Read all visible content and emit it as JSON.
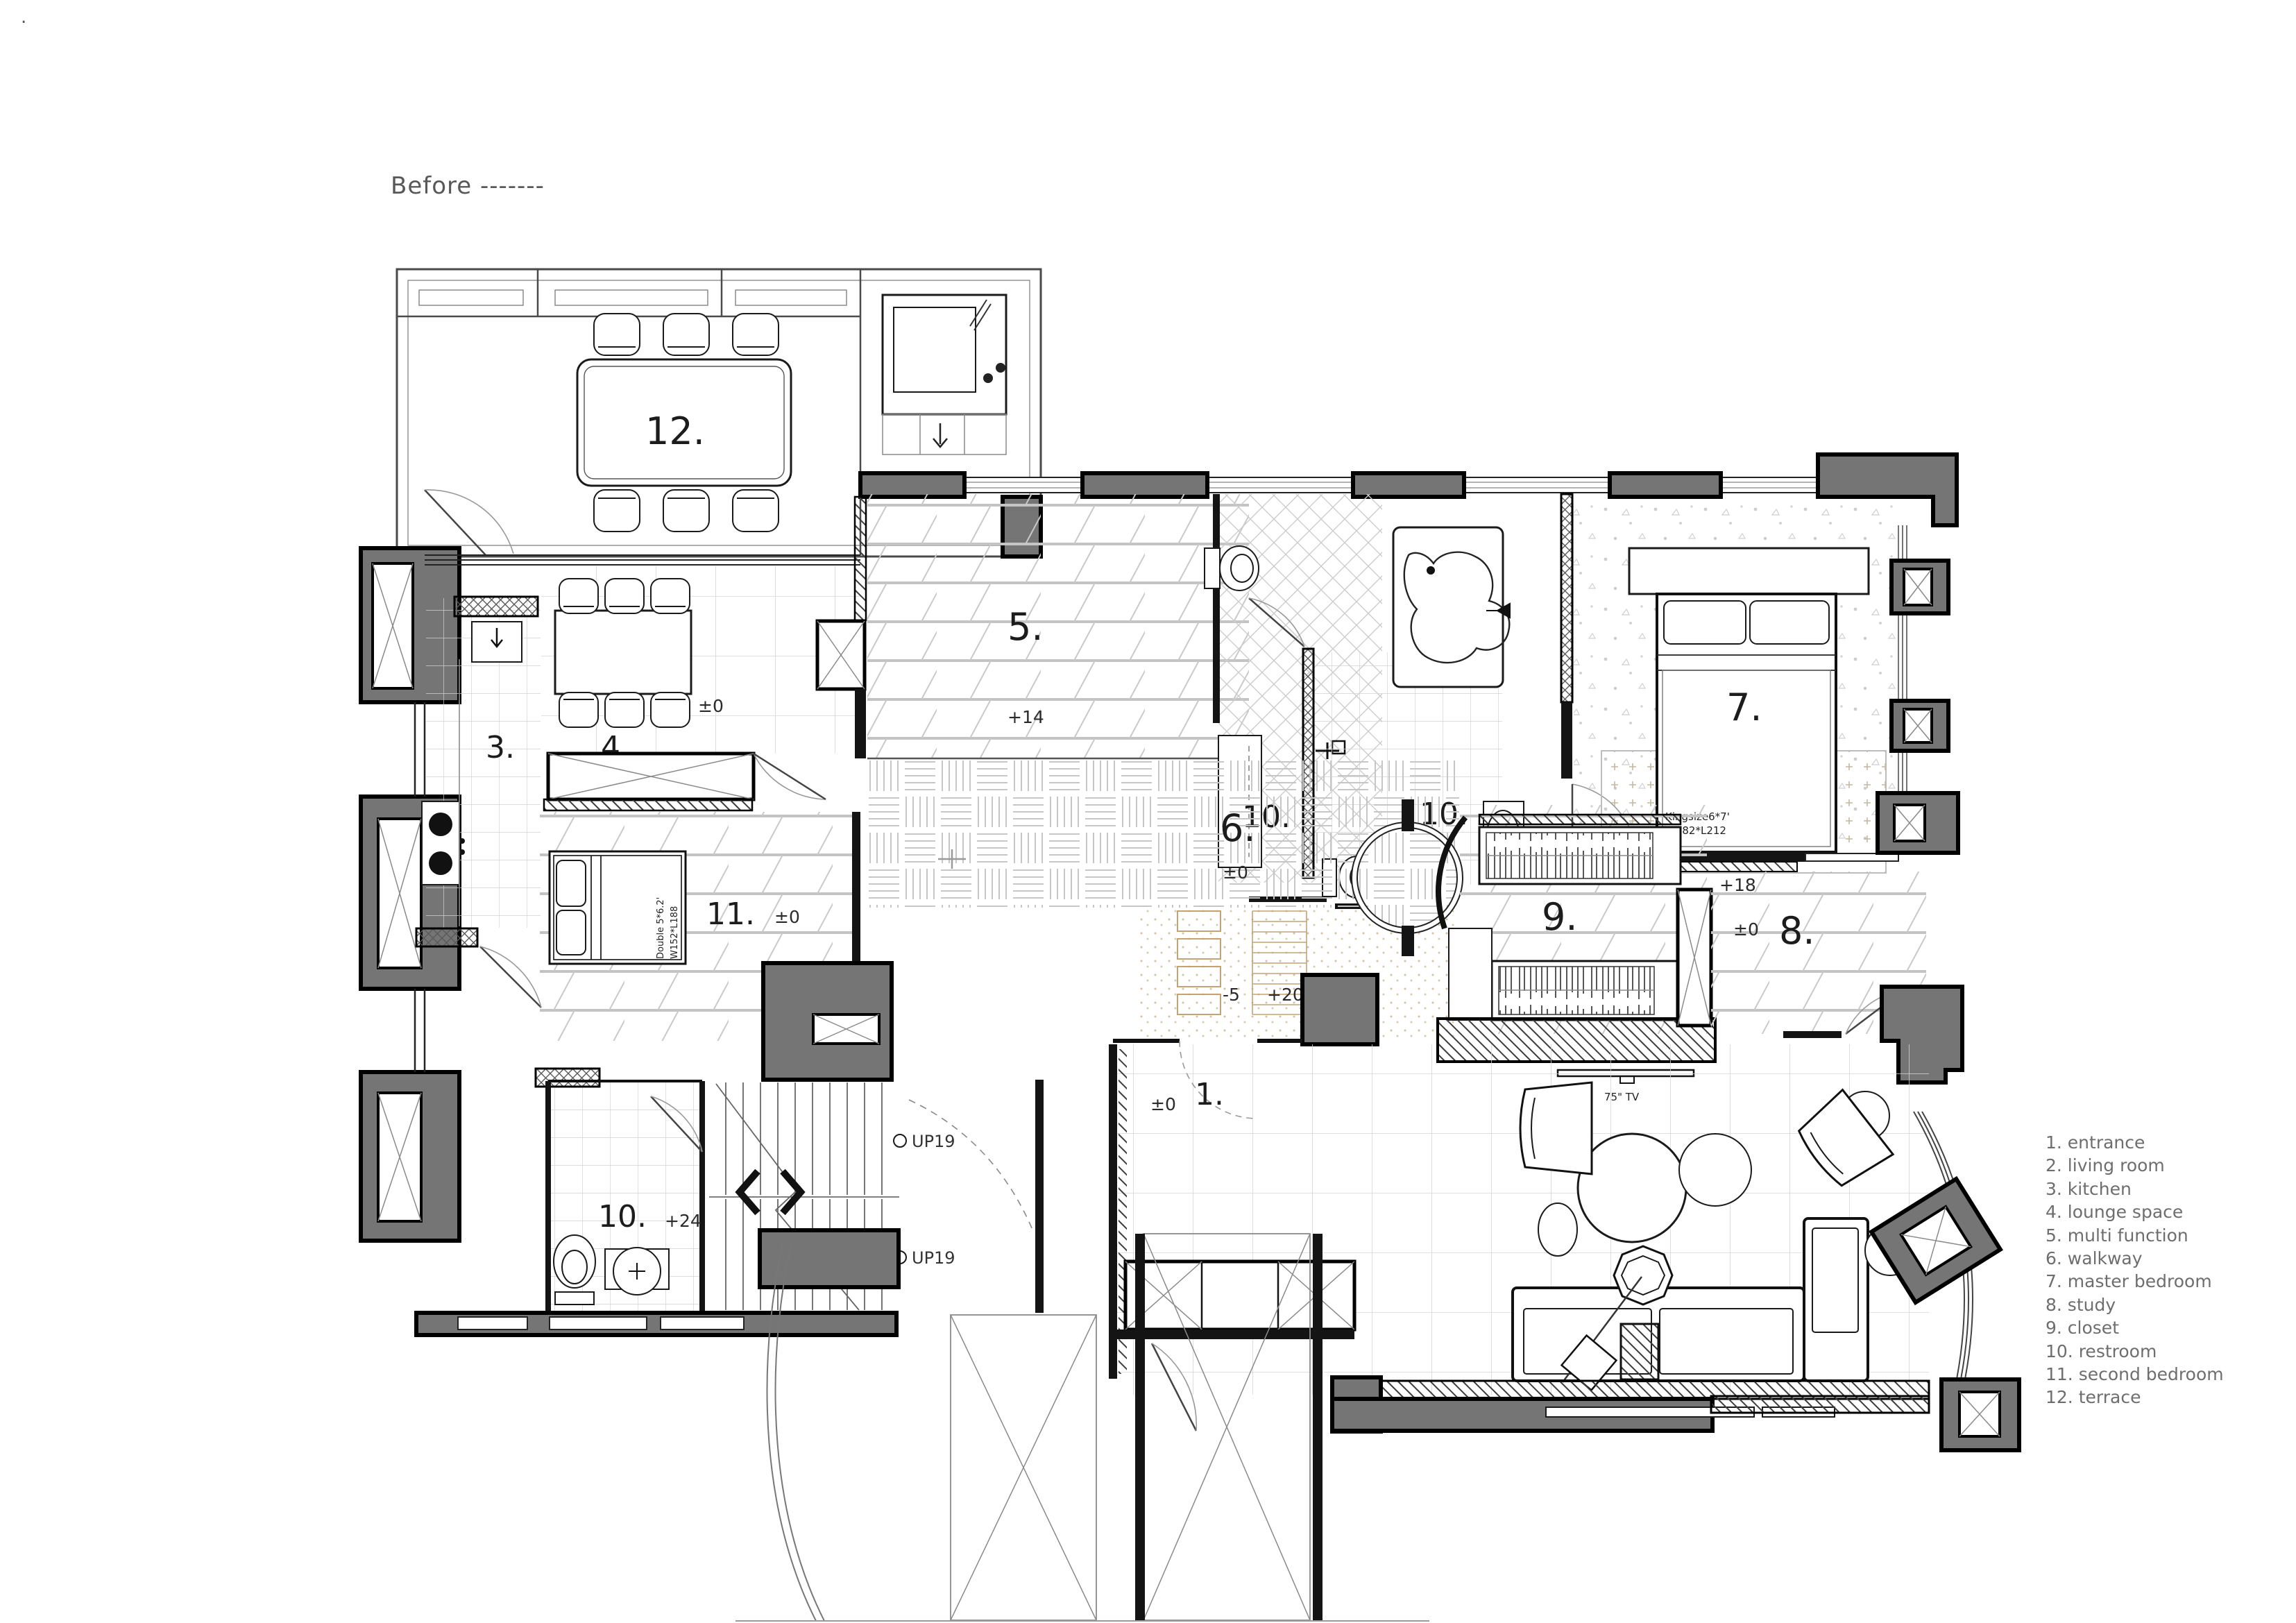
{
  "page": {
    "title": "Before -------",
    "corner_mark": "."
  },
  "legend": {
    "items": [
      "1. entrance",
      "2. living room",
      "3. kitchen",
      "4. lounge space",
      "5. multi function",
      "6. walkway",
      "7. master bedroom",
      "8. study",
      "9. closet",
      "10. restroom",
      "11. second bedroom",
      "12. terrace"
    ]
  },
  "labels": {
    "room1": "1.",
    "room1_level": "±0",
    "room2": "2.",
    "room3": "3.",
    "room4": "4.",
    "room4_level": "±0",
    "room5": "5.",
    "room5_level": "+14",
    "room6": "6.",
    "room6_level": "±0",
    "room7": "7.",
    "room7_level": "+18",
    "room8": "8.",
    "room8_level": "±0",
    "room9": "9.",
    "room10a": "10.",
    "room10b": "10.",
    "room10b_level": "+21",
    "room10c": "10.",
    "room10c_level": "+24",
    "room11": "11.",
    "room11_level": "±0",
    "room12": "12.",
    "dais_level_low": "-5",
    "dais_level_high": "+20",
    "stairs_up_a": "UP19",
    "stairs_up_b": "UP19",
    "tv": "75\" TV",
    "king_bed_line1": "Kingsize6*7'",
    "king_bed_line2": "W182*L212",
    "double_bed_line1": "Double 5*6.2'",
    "double_bed_line2": "W152*L188"
  },
  "colors": {
    "wall": "#757575",
    "line": "#141414",
    "floor_hatch": "#c6c6c6",
    "legend_text": "#6e6e6e"
  }
}
